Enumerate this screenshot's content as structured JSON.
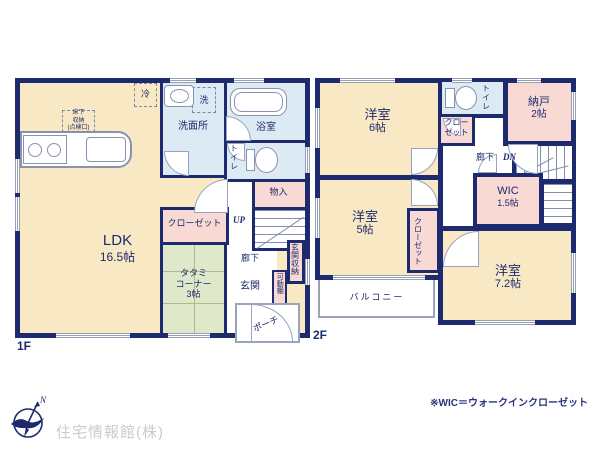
{
  "plan": {
    "floor1_label": "1F",
    "floor2_label": "2F"
  },
  "floor1": {
    "ldk": [
      "LDK",
      "16.5帖"
    ],
    "tatami": [
      "タタミ",
      "コーナー",
      "3帖"
    ],
    "closet": "クローゼット",
    "washroom": "洗面所",
    "washer": "洗",
    "fridge": "冷",
    "bath": "浴室",
    "toilet": "トイレ",
    "storage": "物入",
    "up": "UP",
    "hall": "廊下",
    "entrance": "玄関",
    "entrance_storage": "玄関収納",
    "movable_shelf": "可動棚",
    "porch": "ポーチ",
    "underfloor": [
      "床下",
      "収納",
      "(点検口)"
    ]
  },
  "floor2": {
    "room6": [
      "洋室",
      "6帖"
    ],
    "room5": [
      "洋室",
      "5帖"
    ],
    "room72": [
      "洋室",
      "7.2帖"
    ],
    "closet_a": "クローゼット",
    "closet_b": "クローゼット",
    "storeroom": [
      "納戸",
      "2帖"
    ],
    "toilet": "トイレ",
    "hall": "廊下",
    "dn": "DN",
    "wic": [
      "WIC",
      "1.5帖"
    ],
    "balcony": "バルコニー"
  },
  "footer": {
    "company": "住宅情報館(株)",
    "note": "※WIC＝ウォークインクローゼット",
    "compass_n": "N"
  },
  "colors": {
    "wall": "#1e2a6e",
    "room_cream": "#f8e8c4",
    "closet_pink": "#f8d9d4",
    "wet_blue": "#dcebf3",
    "tatami_green": "#dfe9c9",
    "company_gray": "#cbcbcd"
  }
}
